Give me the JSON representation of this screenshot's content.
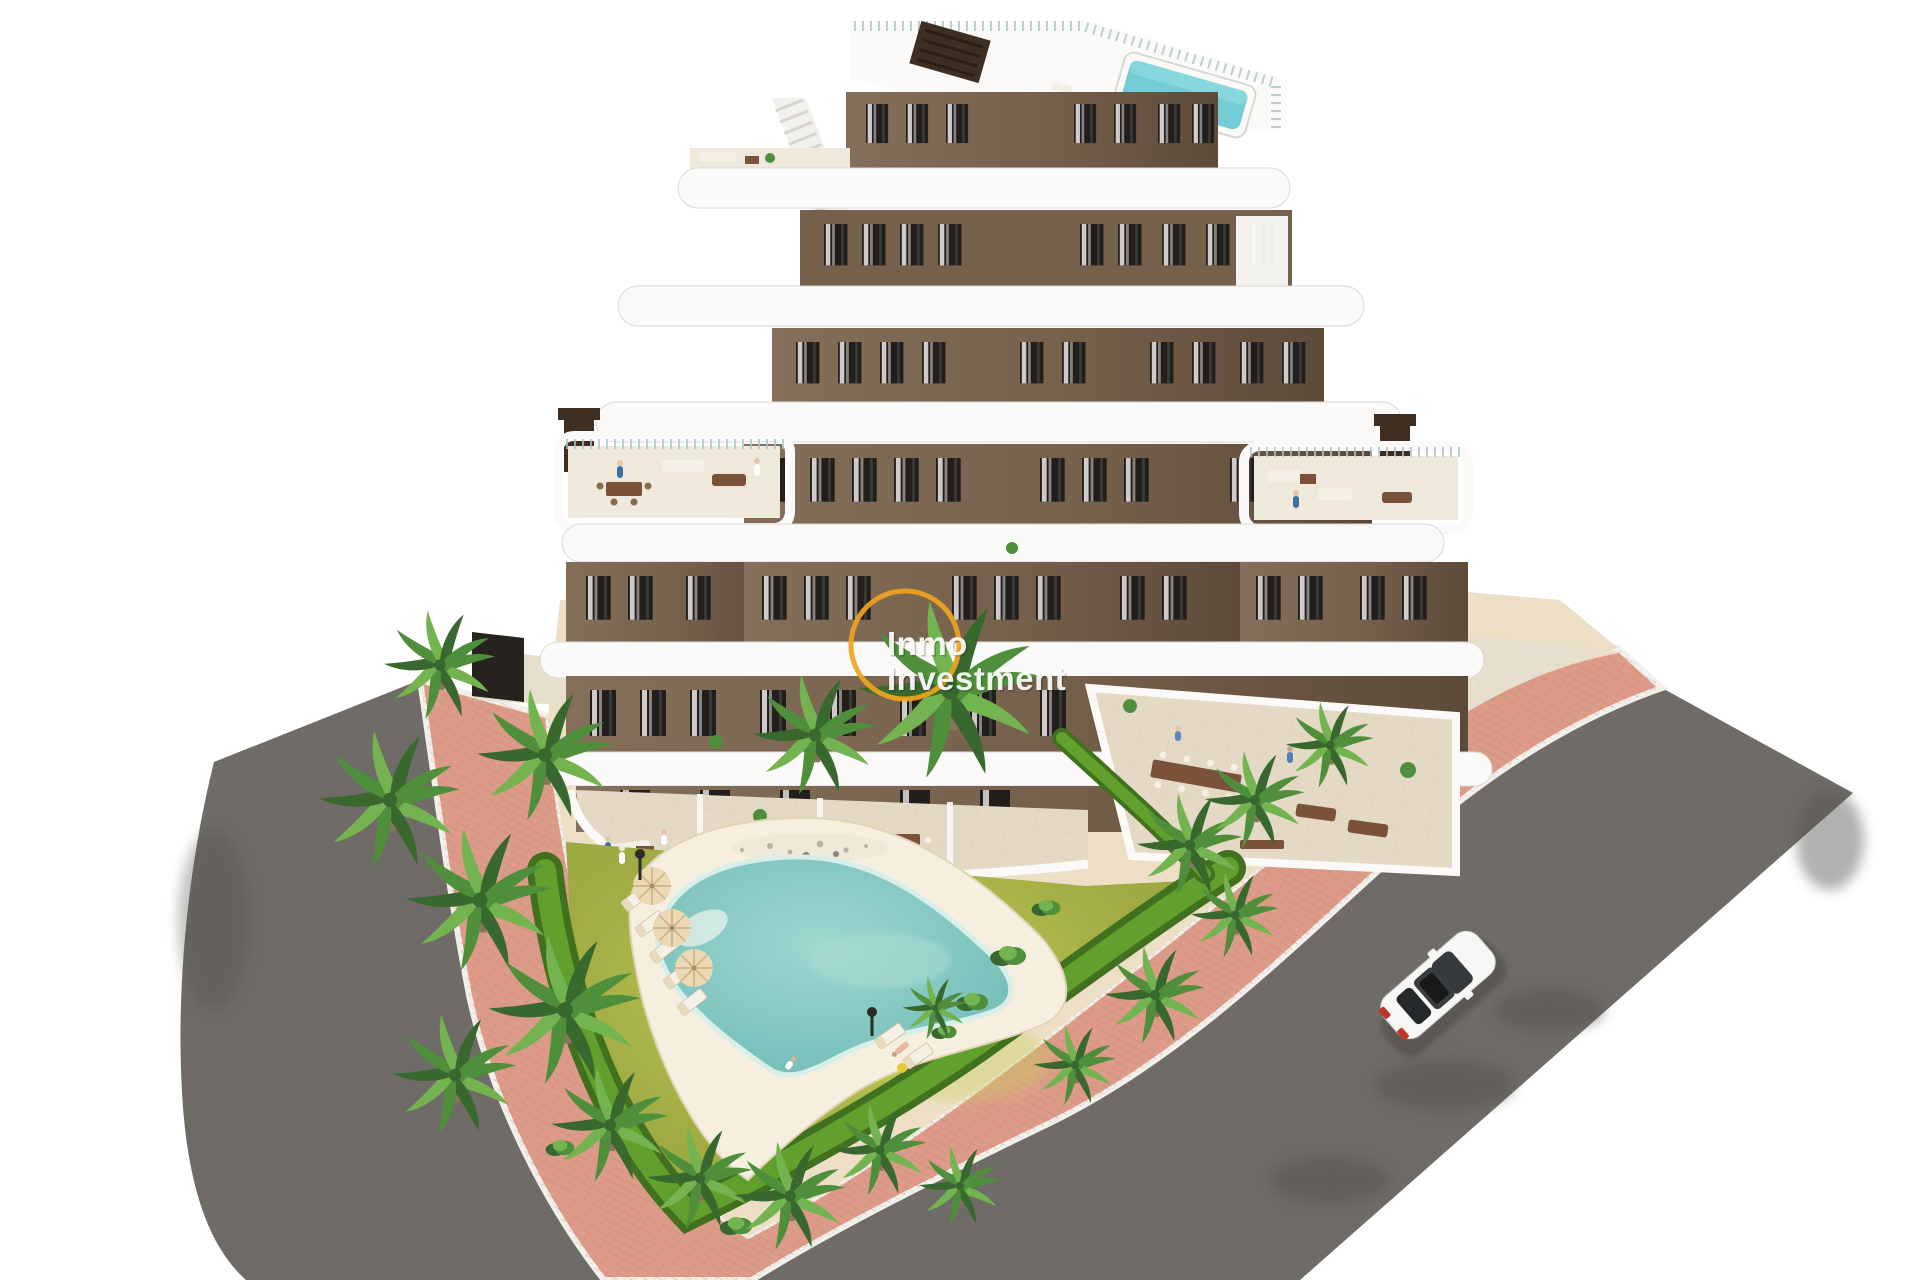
{
  "meta": {
    "width": 1920,
    "height": 1280,
    "kind": "3D architectural aerial render on white background"
  },
  "watermark": {
    "line1": "Inmo",
    "line2": "Investment",
    "ring_color": "#f0a41f",
    "text_color": "#ffffff"
  },
  "scene": {
    "summary": "Aerial view of a modern 7-storey apartment building with brown facades and white curved balcony bands, rooftop pool, communal garden with free-form pool, sun loungers, parasols, palm trees, pink paved sidewalk and asphalt streets with one white car.",
    "building_floors": 7,
    "palm_tree_count": 20,
    "parasol_count": 3,
    "sun_lounger_count": 7,
    "car_count": 1
  },
  "palette": {
    "bg": "#ffffff",
    "wall-light": "#84705a",
    "wall-mid": "#75604b",
    "wall-dark": "#5d4a39",
    "window": "#211e1b",
    "curtain": "#eceae6",
    "band-white": "#fbfaf8",
    "band-shadow": "#dcd9d4",
    "glass-rail": "#adc6cb",
    "roof-pool": "#74cdd6",
    "chimney": "#3f2f22",
    "stair": "#f3f1ed",
    "terrace-floor": "#efe9dc",
    "patio-floor": "#e3d9c5",
    "furn-wood": "#7a523a",
    "furn-light": "#f4f0e6",
    "lawn": "#a4af45",
    "lawn-light": "#c9d25e",
    "hedge-dark": "#41701f",
    "hedge-bright": "#61a02c",
    "palm-dark": "#39682e",
    "palm-mid": "#4f8f3c",
    "palm-light": "#74b450",
    "palm-trunk": "#8a7357",
    "sand": "#ecdfc6",
    "sand-light": "#f6efe0",
    "pool-deep": "#7cc3bd",
    "pool-mid": "#9dd6cf",
    "pool-edge": "#d8efe9",
    "sidewalk": "#dd9c89",
    "sidewalk-line": "#c17c69",
    "curb": "#f2f0ea",
    "road": "#6f6b67",
    "road-dark": "#55524f",
    "walkway": "#e8decd",
    "car-body": "#f7f7f5",
    "car-glass": "#26292c",
    "car-red": "#c23327",
    "people-blue": "#3c6fa5",
    "watermark-yellow": "#f0a41f",
    "watermark-text": "#ffffff"
  }
}
